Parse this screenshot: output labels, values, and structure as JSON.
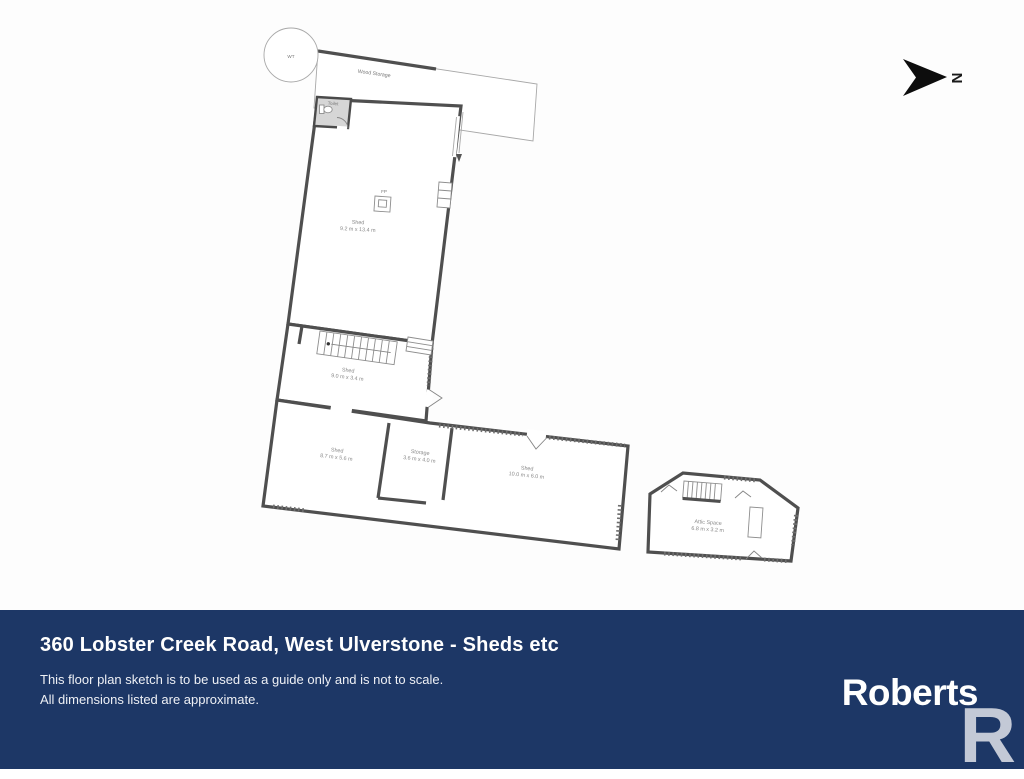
{
  "plan": {
    "north_marker": "N",
    "water_tank": "WT",
    "wood_storage": "Wood Storage",
    "toilet": "Toilet",
    "fireplace": "FP",
    "rooms": [
      {
        "name": "Shed",
        "dims": "9.2 m x 13.4 m"
      },
      {
        "name": "Shed",
        "dims": "9.0 m x 3.4 m"
      },
      {
        "name": "Shed",
        "dims": "8.7 m x 5.6 m"
      },
      {
        "name": "Storage",
        "dims": "3.6 m x 4.0 m"
      },
      {
        "name": "Shed",
        "dims": "10.0 m x 6.0 m"
      },
      {
        "name": "Attic Space",
        "dims": "6.8 m x 3.2 m"
      }
    ]
  },
  "banner": {
    "title": "360 Lobster Creek Road, West Ulverstone - Sheds etc",
    "disclaimer_line1": "This floor plan sketch is to be used as a guide only and is not to scale.",
    "disclaimer_line2": "All dimensions listed are approximate.",
    "brand": "Roberts",
    "brand_initial": "R"
  },
  "colors": {
    "banner_bg": "#1d3766",
    "wall": "#4f4f4f",
    "brand_initial_color": "#c3c9d6"
  }
}
